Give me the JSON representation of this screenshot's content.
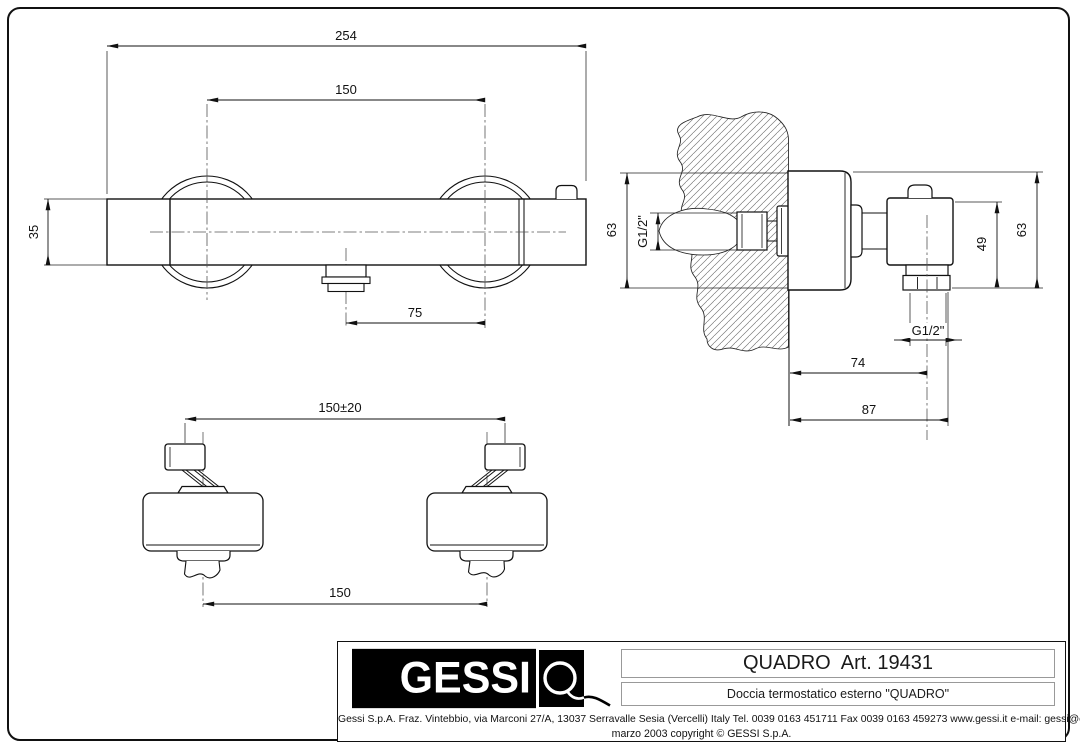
{
  "colors": {
    "line": "#111111",
    "hatch": "#777777",
    "background": "#ffffff",
    "logo_bg": "#000000",
    "logo_fg": "#ffffff"
  },
  "views": {
    "front": {
      "dim_width_total": "254",
      "dim_center_distance": "150",
      "dim_body_height": "35",
      "dim_outlet_offset": "75"
    },
    "side": {
      "dim_left_height": "63",
      "dim_inlet_thread": "G1/2\"",
      "dim_valve_height": "49",
      "dim_right_height": "63",
      "dim_outlet_thread": "G1/2\"",
      "dim_wall_to_outlet": "74",
      "dim_wall_to_front": "87"
    },
    "bottom": {
      "dim_adjustable_span": "150±20",
      "dim_center_distance": "150"
    }
  },
  "title_block": {
    "logo_text": "GESSI",
    "product_name": "QUADRO  Art. 19431",
    "product_description": "Doccia termostatico esterno \"QUADRO\"",
    "address": "Gessi S.p.A. Fraz. Vintebbio, via Marconi 27/A, 13037 Serravalle Sesia  (Vercelli) Italy Tel. 0039 0163 451711 Fax 0039 0163 459273 www.gessi.it  e-mail: gessi@essi.it",
    "copyright": "marzo 2003 copyright © GESSI S.p.A."
  }
}
